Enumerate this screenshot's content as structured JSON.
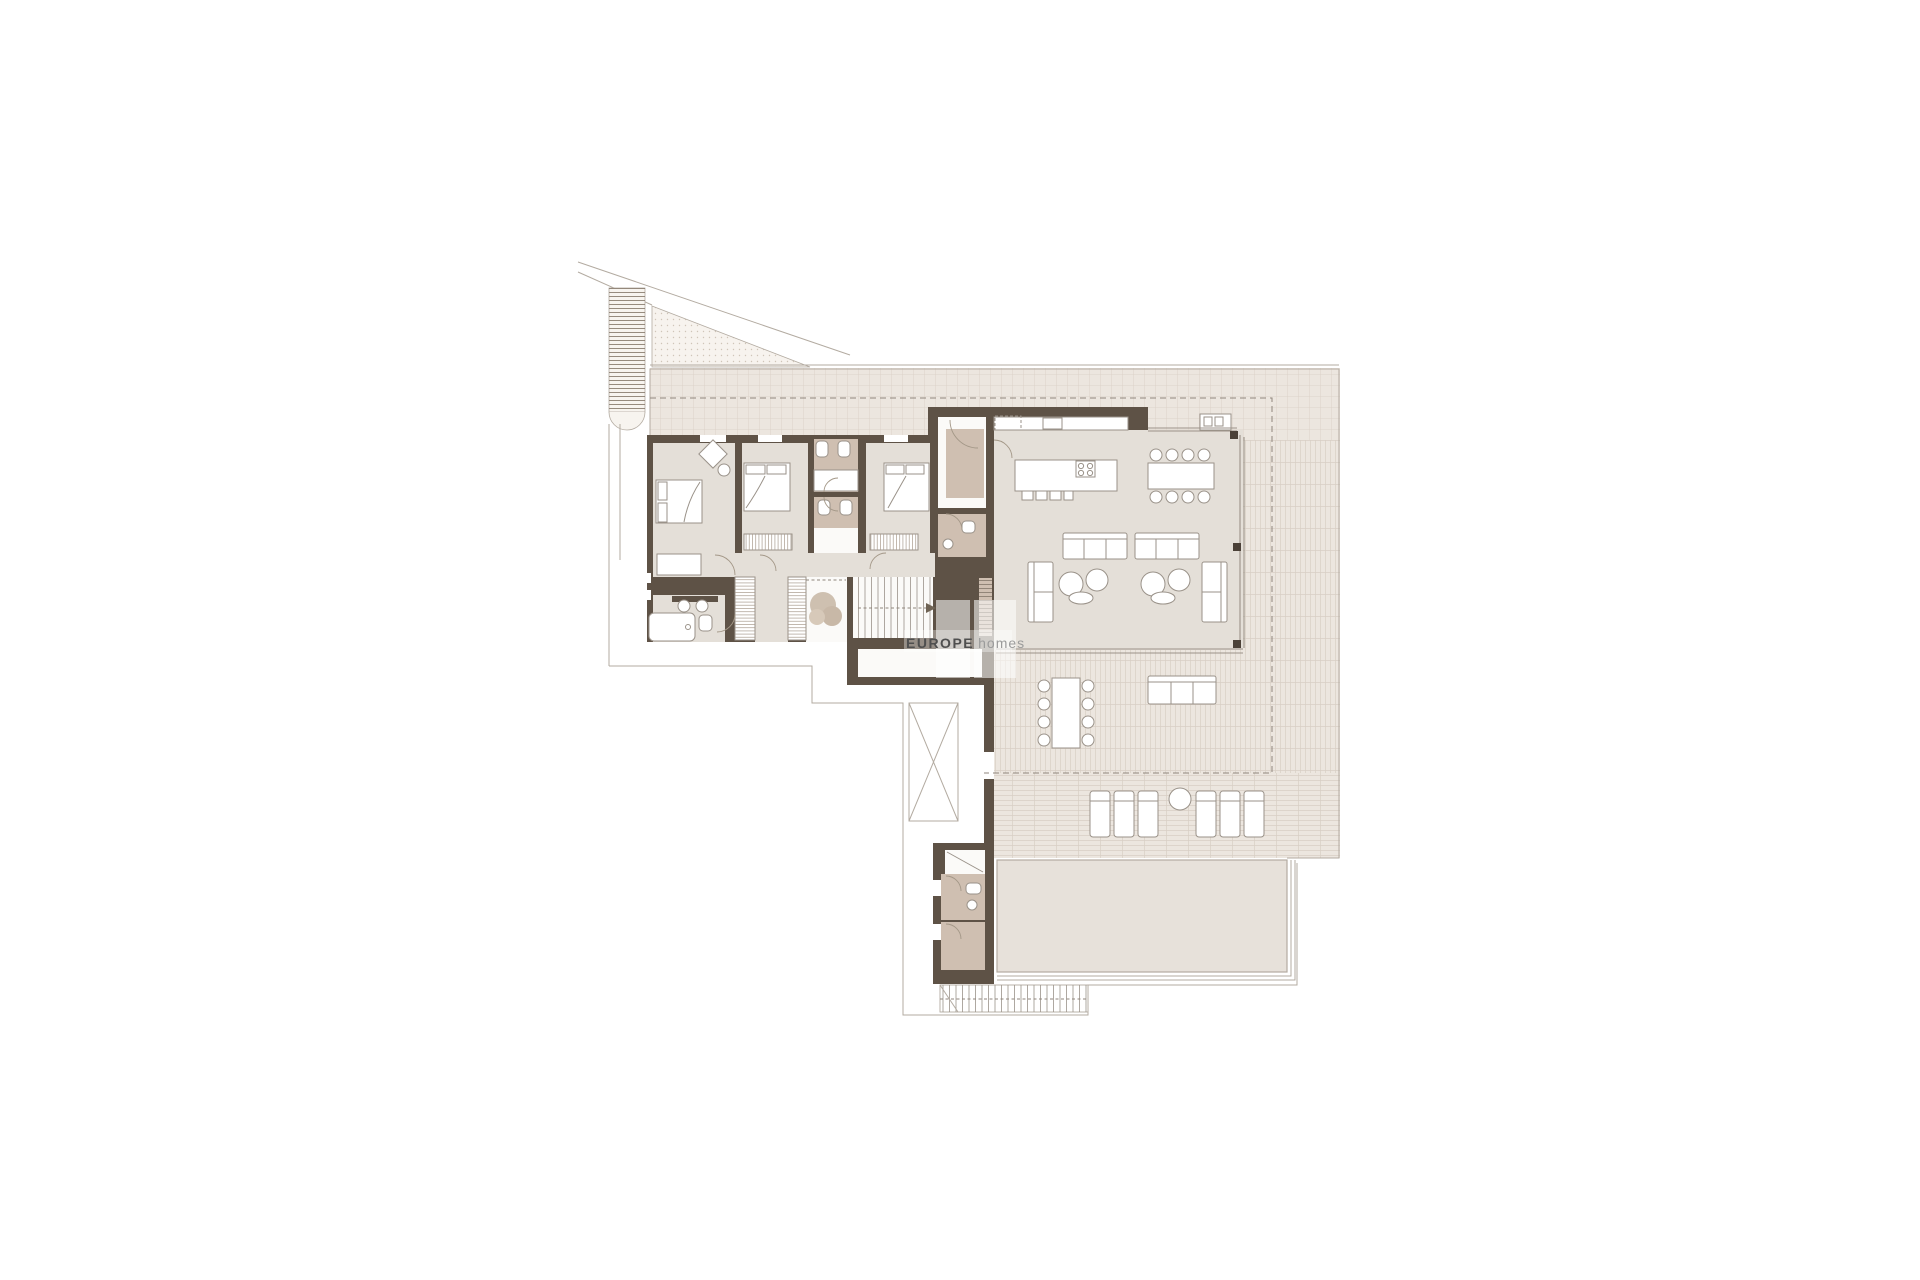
{
  "watermark": {
    "brand_bold": "EUROPE",
    "brand_light": "homes"
  },
  "colors": {
    "bg": "#ffffff",
    "wall": "#5e5246",
    "floor": "#e4dfd8",
    "floor-bath": "#cfbfb1",
    "floor-white": "#fbfaf8",
    "terrace": "#ece6df",
    "terrace-line": "#d8cfc5",
    "pool": "#e7e1da",
    "outline": "#b3aba1",
    "furniture-fill": "#ffffff",
    "furniture-stroke": "#9a9289",
    "dash": "#8f867c",
    "plant": "#c0ad99",
    "column": "#4b4138",
    "wm-dark": "#4f4f4f",
    "wm-light": "#9b9b9b"
  }
}
